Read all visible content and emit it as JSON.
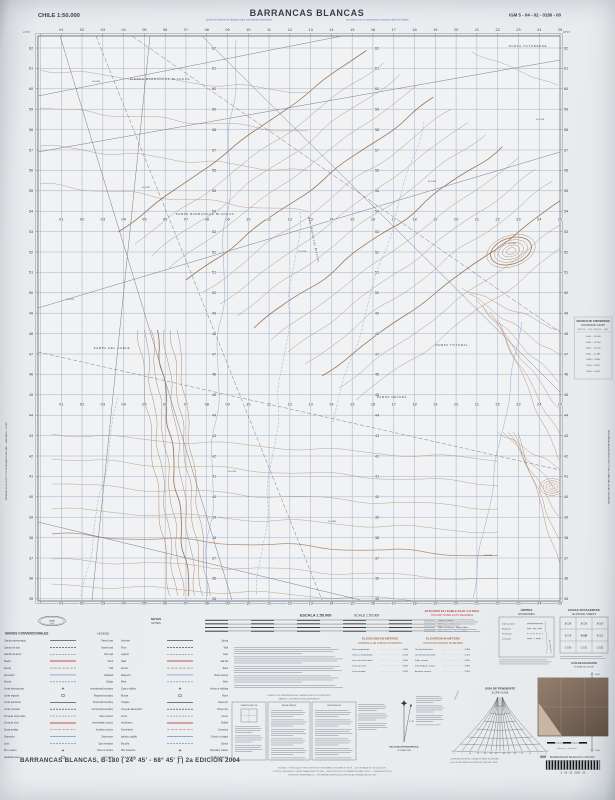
{
  "header": {
    "country_scale": "CHILE 1:50.000",
    "title": "BARRANCAS BLANCAS",
    "sheet_code": "IGM 5 - 04 - 02 - 0180 - 00",
    "note_left": "la línea de frontera fue dibujada según antecedentes disponibles",
    "note_right": "este documento no compromete la posición oficial del Estado",
    "corner_nw": "24°45'",
    "corner_ne": "68°45'"
  },
  "map": {
    "grid": {
      "col_labels": [
        "01",
        "02",
        "03",
        "04",
        "05",
        "06",
        "07",
        "08",
        "09",
        "10",
        "11",
        "12",
        "13",
        "14",
        "15",
        "16",
        "17",
        "18",
        "19",
        "20",
        "21",
        "22",
        "23",
        "24",
        "25"
      ],
      "row_labels": [
        "62",
        "61",
        "60",
        "59",
        "58",
        "57",
        "56",
        "55",
        "54",
        "53",
        "52",
        "51",
        "50",
        "49",
        "48",
        "47",
        "46",
        "45",
        "44",
        "43",
        "42",
        "41",
        "40",
        "39",
        "38",
        "37",
        "36",
        "35"
      ],
      "x0": 40.5,
      "x_step": 20.78,
      "y0": 48,
      "y_step": 20.4,
      "col_label_rows_y": [
        31,
        220.5,
        405.5,
        604.5
      ],
      "row_label_cols_x": [
        31,
        214,
        377,
        566
      ],
      "frame": {
        "left": 38,
        "top": 36,
        "right": 560,
        "bottom": 601
      }
    },
    "place_labels": [
      {
        "text": "SIERRA BARRANCAS BLANCAS",
        "x": 160,
        "y": 80
      },
      {
        "text": "PUNTA TOTORENSE",
        "x": 528,
        "y": 47
      },
      {
        "text": "PAMPA BARRANCAS BLANCAS",
        "x": 205,
        "y": 215
      },
      {
        "text": "PAMPA DEL CABLE",
        "x": 112,
        "y": 349
      },
      {
        "text": "PAMPA TOTORAL",
        "x": 452,
        "y": 346
      },
      {
        "text": "PAMPA NEVADA",
        "x": 392,
        "y": 398
      },
      {
        "text": "Qda. Barrancas Blancas",
        "x": 313,
        "y": 240,
        "rotate": 78,
        "italic": true
      }
    ],
    "spot_elevations": [
      {
        "t": "4.365",
        "x": 96,
        "y": 82
      },
      {
        "t": "4.182",
        "x": 146,
        "y": 188
      },
      {
        "t": "4.074",
        "x": 70,
        "y": 300
      },
      {
        "t": "4.210",
        "x": 302,
        "y": 252
      },
      {
        "t": "4.462",
        "x": 432,
        "y": 182
      },
      {
        "t": "4.705",
        "x": 512,
        "y": 244
      },
      {
        "t": "4.318",
        "x": 540,
        "y": 120
      },
      {
        "t": "4.150",
        "x": 232,
        "y": 472
      },
      {
        "t": "3.980",
        "x": 332,
        "y": 522
      },
      {
        "t": "4.033",
        "x": 488,
        "y": 556
      }
    ]
  },
  "margins": {
    "left_imprint": "IMPRESO EN EL INSTITUTO GEOGRÁFICO MILITAR — SANTIAGO — CHILE",
    "right_imprint": "PROHIBIDA LA REPRODUCCIÓN TOTAL O PARCIAL SIN AUTORIZACIÓN"
  },
  "footer": {
    "logo": {
      "abbr": "I.G.M.",
      "country": "CHILE"
    },
    "legend": {
      "title_es": "SIGNOS CONVENCIONALES",
      "title_en": "LEGEND",
      "items": [
        {
          "es": "Camino pavimentado",
          "en": "Paved road"
        },
        {
          "es": "Camino de ripio",
          "en": "Gravel road"
        },
        {
          "es": "Camino de tierra",
          "en": "Dirt road"
        },
        {
          "es": "Huella",
          "en": "Track"
        },
        {
          "es": "Senda",
          "en": "Trail"
        },
        {
          "es": "Ferrocarril",
          "en": "Railroad"
        },
        {
          "es": "Puente",
          "en": "Bridge"
        },
        {
          "es": "Límite internacional",
          "en": "International boundary"
        },
        {
          "es": "Límite regional",
          "en": "Regional boundary"
        },
        {
          "es": "Límite provincial",
          "en": "Provincial boundary"
        },
        {
          "es": "Límite comunal",
          "en": "Communal boundary"
        },
        {
          "es": "Curva de nivel índice",
          "en": "Index contour"
        },
        {
          "es": "Curva de nivel",
          "en": "Intermediate contour"
        },
        {
          "es": "Curva auxiliar",
          "en": "Auxiliary contour"
        },
        {
          "es": "Depresión",
          "en": "Depression"
        },
        {
          "es": "Cota",
          "en": "Spot elevation"
        },
        {
          "es": "Río o estero",
          "en": "River or stream"
        },
        {
          "es": "Quebrada seca",
          "en": "Dry wash"
        },
        {
          "es": "Vertiente",
          "en": "Spring"
        },
        {
          "es": "Pozo",
          "en": "Well"
        },
        {
          "es": "Laguna",
          "en": "Lake"
        },
        {
          "es": "Salar",
          "en": "Salt flat"
        },
        {
          "es": "Arenal",
          "en": "Sand"
        },
        {
          "es": "Roquerío",
          "en": "Rock outcrop"
        },
        {
          "es": "Mina",
          "en": "Mine"
        },
        {
          "es": "Casa o edificio",
          "en": "House or building"
        },
        {
          "es": "Ruinas",
          "en": "Ruins"
        },
        {
          "es": "Tranque",
          "en": "Reservoir"
        },
        {
          "es": "Línea de alta tensión",
          "en": "Power line"
        },
        {
          "es": "Cerco",
          "en": "Fence"
        },
        {
          "es": "Aeródromo",
          "en": "Airfield"
        },
        {
          "es": "Cementerio",
          "en": "Cemetery"
        },
        {
          "es": "Iglesia o capilla",
          "en": "Church or chapel"
        },
        {
          "es": "Escuela",
          "en": "School"
        },
        {
          "es": "Hito fronterizo",
          "en": "Boundary marker"
        },
        {
          "es": "Torre o antena",
          "en": "Tower or antenna"
        }
      ]
    },
    "notes": {
      "title_es": "NOTAS",
      "title_en": "NOTES"
    },
    "scale": {
      "title_es": "ESCALA 1:50.000",
      "title_en": "SCALE 1:50.000",
      "bars": [
        "Metros - Meters",
        "Kilómetros - Kilometers",
        "Millas Terrestres - Statute Miles",
        "Millas Náuticas - Nautical Miles"
      ]
    },
    "red_notice": {
      "line_es": "ESTE MAPA ES LEGIBLE BAJO LUZ ROJA",
      "line_en": "THE MAP IS RED-LIGHT READABLE"
    },
    "elevation": {
      "title_es": "ELEVACIÓN EN METROS",
      "subtitle_es": "INTERVALO DE CURVAS 50 METROS",
      "title_en": "ELEVATION IN METERS",
      "subtitle_en": "CONTOUR INTERVAL 50 METERS",
      "rows_es": [
        [
          "Cota comprobada",
          "4.365"
        ],
        [
          "Cota no comprobada",
          "4.120"
        ],
        [
          "Curva de nivel índice",
          "4.000"
        ],
        [
          "Curva de nivel",
          "3.950"
        ],
        [
          "Curva auxiliar",
          "3.925"
        ]
      ],
      "rows_en": [
        [
          "Checked elevation",
          "4.365"
        ],
        [
          "Unchecked elevation",
          "4.120"
        ],
        [
          "Index contour",
          "4.000"
        ],
        [
          "Intermediate contour",
          "3.950"
        ],
        [
          "Auxiliary contour",
          "3.925"
        ]
      ]
    },
    "limits": {
      "title_es": "LÍMITES",
      "title_en": "BOUNDARIES",
      "items": [
        "Internacional",
        "Regional",
        "Provincial",
        "Comunal"
      ],
      "neighbor": "REP. ARGENTINA"
    },
    "adjoining": {
      "title_es": "HOJAS ADYACENTES",
      "title_en": "ADJOINING SHEETS",
      "cells": [
        "B-158",
        "B-159",
        "B-160",
        "B-179",
        "B-180",
        "B-181",
        "C-190",
        "C-191",
        "C-192"
      ]
    },
    "elev_guide": {
      "title_es": "GUÍA DE ELEVACIÓN",
      "title_en": "ELEVATION GUIDE",
      "ticks": [
        "6.000",
        "5.000",
        "4.000",
        "3.000",
        "2.000"
      ]
    },
    "conversion": {
      "title_es": "GRÁFICO DE CONVERSIÓN",
      "title_en": "CONVERSION GRAPH",
      "subtitle": "METROS — PIES · METERS — FEET",
      "rows": [
        "5.000 — 16.404",
        "4.500 — 14.764",
        "4.000 — 13.123",
        "3.500 — 11.483",
        "3.000 — 9.843",
        "2.500 — 8.202",
        "2.000 — 6.562"
      ]
    },
    "grid_ref": {
      "lines": [
        "EJEMPLO DE REFERENCIA DE CUADRÍCULA DE 1.000 METROS",
        "SAMPLE 1.000 METER GRID REFERENCE"
      ],
      "box1_note": "CUADRÍCULA U.T.M.",
      "box2_note": "DATUM PSAD-56",
      "box3_note": "DATUM WGS-84"
    },
    "declination": {
      "title": "DECLINACIÓN MAGNÉTICA",
      "date": "OCTUBRE 2003",
      "value": "4° 30'"
    },
    "slope": {
      "title_es": "GUÍA DE PENDIENTE",
      "title_en": "SLOPE GUIDE",
      "left_axis": "TANGENTE",
      "right_axis": "GRADOS",
      "ticks": [
        "45",
        "30",
        "20",
        "15",
        "10",
        "7",
        "5"
      ],
      "fn_a": "a) PENDIENTE ENTRE CURVAS DE NIVEL SUCESIVAS",
      "fn_b": "b) SLOPE BETWEEN SUCCESSIVE CONTOUR LINES"
    },
    "inset": {
      "caption": "Kilómetros — Kilometers"
    },
    "product": {
      "brand": "IGM",
      "name": "BARRANCAS BLANCAS 1:50.000",
      "barcode_digits": "5   04   02   0180   00"
    },
    "credits": [
      "EDITADO Y PUBLICADO POR EL INSTITUTO GEOGRÁFICO MILITAR DE CHILE — AUTORIZADA SU CIRCULACIÓN",
      "CONTROL GEODÉSICO Y AEROTRIANGULACIÓN IGM — RESTITUCIÓN FOTOGRAMÉTRICA AÑO 2003 — COMPILACIÓN 2004",
      "DERECHOS RESERVADOS — PROHIBIDA LA REPRODUCCIÓN SIN AUTORIZACIÓN DEL IGM"
    ],
    "edition_line": "BARRANCAS BLANCAS, B-180 ( 24° 45' - 68° 45' ) | 2a EDICIÓN 2004"
  }
}
